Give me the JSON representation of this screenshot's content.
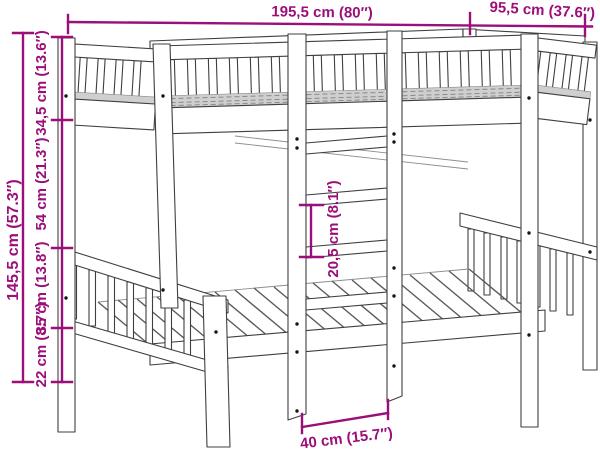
{
  "colors": {
    "accent": "#9b0f7a",
    "line": "#3f3f3f"
  },
  "dimensions": {
    "length": "195,5 cm (80″)",
    "depth": "95,5 cm (37.6″)",
    "total_height": "145,5 cm (57.3″)",
    "guardrail_height": "34,5 cm (13.6″)",
    "bunk_gap_height": "54 cm (21.3″)",
    "lower_bunk_height": "35 cm (13.8″)",
    "under_bed_clearance": "22 cm (8.7″)",
    "ladder_rung_spacing": "20,5 cm (8.1″)",
    "ladder_width": "40 cm (15.7″)"
  }
}
